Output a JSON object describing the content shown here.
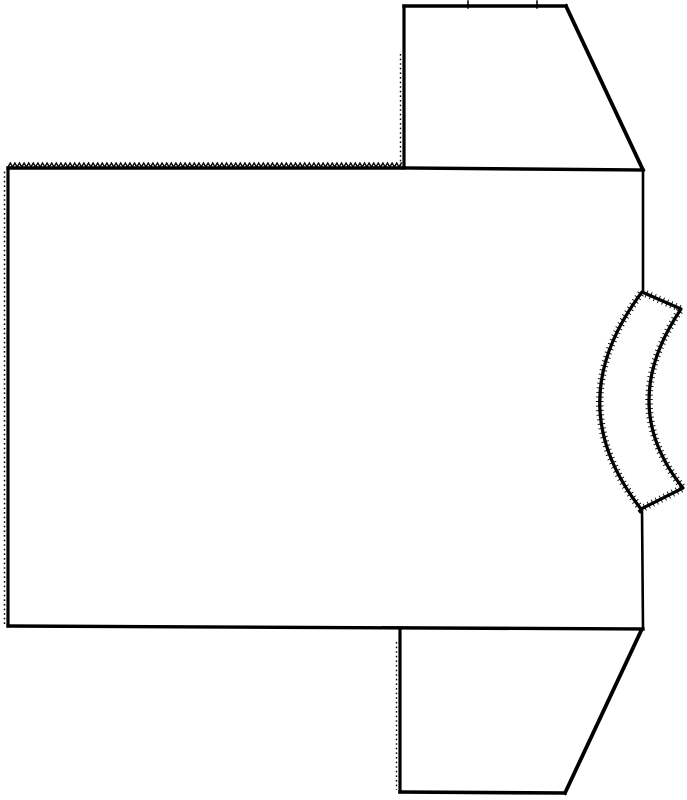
{
  "canvas": {
    "width": 687,
    "height": 800,
    "background": "#ffffff",
    "ink": "#000000"
  },
  "figure": {
    "label": "T-shirt sewing pattern line drawing, garment rotated sideways: body panel, two sleeves, curved neckband"
  },
  "shapes": [
    {
      "id": "body-panel",
      "strokes": [
        {
          "kind": "zigzag",
          "x1": 8,
          "y1": 167,
          "x2": 403,
          "y2": 167,
          "amp": 4,
          "step": 4.6,
          "width": 1.4
        },
        {
          "kind": "line",
          "x1": 8,
          "y1": 168,
          "x2": 403,
          "y2": 168,
          "width": 3.4
        },
        {
          "kind": "line",
          "x1": 403,
          "y1": 168,
          "x2": 643,
          "y2": 170,
          "width": 3.4
        },
        {
          "kind": "line",
          "x1": 643,
          "y1": 170,
          "x2": 643,
          "y2": 293,
          "width": 2.6
        },
        {
          "kind": "line",
          "x1": 642,
          "y1": 509,
          "x2": 643,
          "y2": 629,
          "width": 2.6
        },
        {
          "kind": "line",
          "x1": 643,
          "y1": 629,
          "x2": 8,
          "y2": 626,
          "width": 3.4
        },
        {
          "kind": "line",
          "x1": 8,
          "y1": 626,
          "x2": 8,
          "y2": 168,
          "width": 3.2
        },
        {
          "kind": "dashline",
          "x1": 4.5,
          "y1": 624,
          "x2": 4.5,
          "y2": 170,
          "width": 1.5,
          "dash": "1.6 3.0"
        }
      ]
    },
    {
      "id": "top-sleeve",
      "strokes": [
        {
          "kind": "line",
          "x1": 404,
          "y1": 168,
          "x2": 404,
          "y2": 6,
          "width": 3.2
        },
        {
          "kind": "dashline",
          "x1": 400.5,
          "y1": 166,
          "x2": 400.5,
          "y2": 52,
          "width": 1.4,
          "dash": "1.6 3.0"
        },
        {
          "kind": "line",
          "x1": 404,
          "y1": 6,
          "x2": 566,
          "y2": 6,
          "width": 3.6
        },
        {
          "kind": "line",
          "x1": 566,
          "y1": 6,
          "x2": 643,
          "y2": 170,
          "width": 3.8
        },
        {
          "kind": "tick",
          "x1": 468,
          "y1": 1,
          "x2": 468,
          "y2": 8,
          "width": 1.5
        },
        {
          "kind": "tick",
          "x1": 537,
          "y1": 1,
          "x2": 537,
          "y2": 8,
          "width": 1.5
        }
      ]
    },
    {
      "id": "bottom-sleeve",
      "strokes": [
        {
          "kind": "line",
          "x1": 400,
          "y1": 629,
          "x2": 400,
          "y2": 792,
          "width": 3.2
        },
        {
          "kind": "dashline",
          "x1": 396.5,
          "y1": 642,
          "x2": 396.5,
          "y2": 790,
          "width": 1.4,
          "dash": "1.6 3.0"
        },
        {
          "kind": "line",
          "x1": 400,
          "y1": 792,
          "x2": 565,
          "y2": 793,
          "width": 3.6
        },
        {
          "kind": "line",
          "x1": 565,
          "y1": 793,
          "x2": 641,
          "y2": 631,
          "width": 3.8
        }
      ]
    },
    {
      "id": "neckband",
      "strokes": [
        {
          "kind": "path",
          "d": [
            [
              "M",
              642,
              292
            ],
            [
              "L",
              681,
              309
            ],
            [
              "Q",
              616,
              405,
              683,
              488
            ],
            [
              "L",
              641,
              509
            ],
            [
              "Q",
              558,
              403,
              642,
              292
            ],
            [
              "Z"
            ]
          ],
          "width": 3.2,
          "fill": "#ffffff",
          "fuzz": {
            "width": 7.5,
            "dash": "0.9 3.6"
          }
        }
      ]
    }
  ]
}
